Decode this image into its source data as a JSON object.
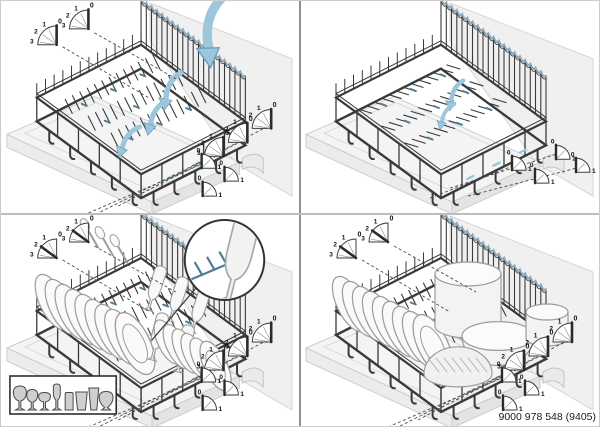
{
  "figure": {
    "part_number": "9000 978 548 (9405)"
  },
  "colors": {
    "accent_blue": "#9CC6DC",
    "accent_blue_dark": "#4E7E96",
    "fence_highlight": "#8FA9BA",
    "wire": "#3A3A3A",
    "wall_fill": "#F0F0F0",
    "base_fill": "#F4F4F4",
    "outline_gray": "#9C9C9C",
    "dish_fill": "#FAFAFA",
    "legend_glass_fill": "#CFCFCF",
    "divider_dark": "#8F8F8F",
    "divider_light": "#BDBDBD"
  },
  "dials": {
    "four_position_labels": [
      "0",
      "1",
      "2",
      "3"
    ],
    "two_position_labels": [
      "0",
      "1"
    ]
  },
  "panels": [
    {
      "id": "fold-down-tines",
      "icons": [
        "fold-arrow-icon",
        "position-dial-icon",
        "tine-row-icon"
      ]
    },
    {
      "id": "tines-folded-flat",
      "icons": [
        "fold-arrow-icon",
        "position-dial-icon"
      ]
    },
    {
      "id": "load-plates-and-glasses",
      "icons": [
        "position-dial-icon",
        "tine-detail-inset-icon",
        "glass-types-legend"
      ]
    },
    {
      "id": "load-pots-and-bowls",
      "icons": [
        "position-dial-icon"
      ]
    }
  ],
  "legend": {
    "glass_icons": [
      "wine-glass-large-icon",
      "wine-glass-medium-icon",
      "wine-glass-small-icon",
      "champagne-flute-icon",
      "tumbler-icon",
      "tapered-tumbler-icon",
      "pilsner-glass-icon",
      "brandy-glass-icon"
    ]
  }
}
